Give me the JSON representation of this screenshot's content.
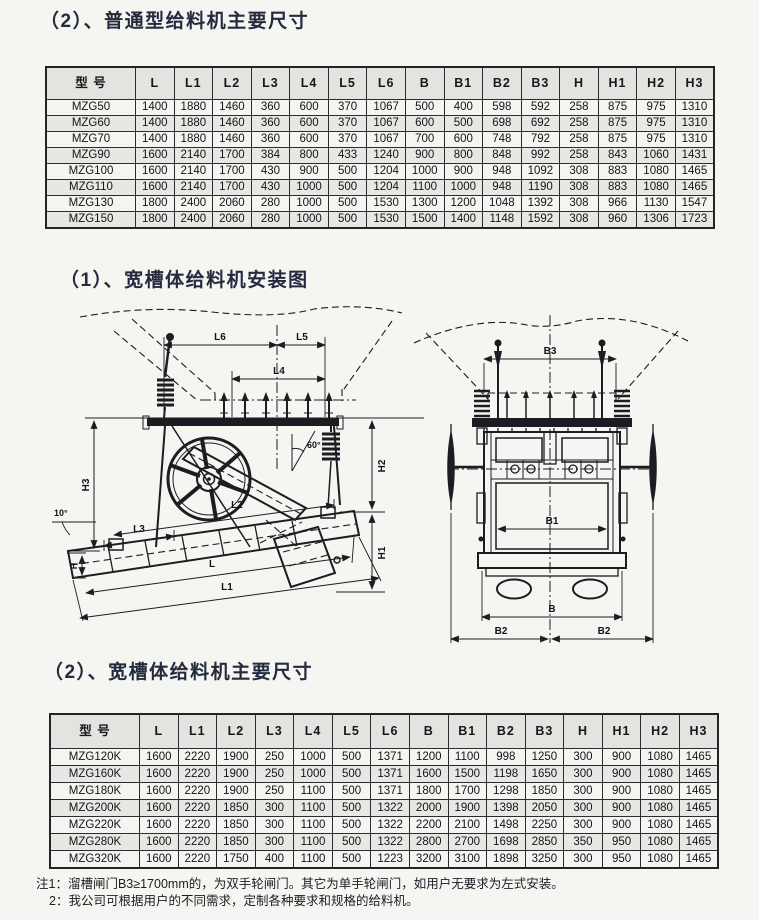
{
  "sections": {
    "s1_title": "（2）、普通型给料机主要尺寸",
    "s2_title": "（1）、宽槽体给料机安装图",
    "s3_title": "（2）、宽槽体给料机主要尺寸"
  },
  "table1": {
    "headers": [
      "型 号",
      "L",
      "L1",
      "L2",
      "L3",
      "L4",
      "L5",
      "L6",
      "B",
      "B1",
      "B2",
      "B3",
      "H",
      "H1",
      "H2",
      "H3"
    ],
    "rows": [
      [
        "MZG50",
        "1400",
        "1880",
        "1460",
        "360",
        "600",
        "370",
        "1067",
        "500",
        "400",
        "598",
        "592",
        "258",
        "875",
        "975",
        "1310"
      ],
      [
        "MZG60",
        "1400",
        "1880",
        "1460",
        "360",
        "600",
        "370",
        "1067",
        "600",
        "500",
        "698",
        "692",
        "258",
        "875",
        "975",
        "1310"
      ],
      [
        "MZG70",
        "1400",
        "1880",
        "1460",
        "360",
        "600",
        "370",
        "1067",
        "700",
        "600",
        "748",
        "792",
        "258",
        "875",
        "975",
        "1310"
      ],
      [
        "MZG90",
        "1600",
        "2140",
        "1700",
        "384",
        "800",
        "433",
        "1240",
        "900",
        "800",
        "848",
        "992",
        "258",
        "843",
        "1060",
        "1431"
      ],
      [
        "MZG100",
        "1600",
        "2140",
        "1700",
        "430",
        "900",
        "500",
        "1204",
        "1000",
        "900",
        "948",
        "1092",
        "308",
        "883",
        "1080",
        "1465"
      ],
      [
        "MZG110",
        "1600",
        "2140",
        "1700",
        "430",
        "1000",
        "500",
        "1204",
        "1100",
        "1000",
        "948",
        "1190",
        "308",
        "883",
        "1080",
        "1465"
      ],
      [
        "MZG130",
        "1800",
        "2400",
        "2060",
        "280",
        "1000",
        "500",
        "1530",
        "1300",
        "1200",
        "1048",
        "1392",
        "308",
        "966",
        "1130",
        "1547"
      ],
      [
        "MZG150",
        "1800",
        "2400",
        "2060",
        "280",
        "1000",
        "500",
        "1530",
        "1500",
        "1400",
        "1148",
        "1592",
        "308",
        "960",
        "1306",
        "1723"
      ]
    ]
  },
  "table2": {
    "headers": [
      "型 号",
      "L",
      "L1",
      "L2",
      "L3",
      "L4",
      "L5",
      "L6",
      "B",
      "B1",
      "B2",
      "B3",
      "H",
      "H1",
      "H2",
      "H3"
    ],
    "rows": [
      [
        "MZG120K",
        "1600",
        "2220",
        "1900",
        "250",
        "1000",
        "500",
        "1371",
        "1200",
        "1100",
        "998",
        "1250",
        "300",
        "900",
        "1080",
        "1465"
      ],
      [
        "MZG160K",
        "1600",
        "2220",
        "1900",
        "250",
        "1000",
        "500",
        "1371",
        "1600",
        "1500",
        "1198",
        "1650",
        "300",
        "900",
        "1080",
        "1465"
      ],
      [
        "MZG180K",
        "1600",
        "2220",
        "1900",
        "250",
        "1100",
        "500",
        "1371",
        "1800",
        "1700",
        "1298",
        "1850",
        "300",
        "900",
        "1080",
        "1465"
      ],
      [
        "MZG200K",
        "1600",
        "2220",
        "1850",
        "300",
        "1100",
        "500",
        "1322",
        "2000",
        "1900",
        "1398",
        "2050",
        "300",
        "900",
        "1080",
        "1465"
      ],
      [
        "MZG220K",
        "1600",
        "2220",
        "1850",
        "300",
        "1100",
        "500",
        "1322",
        "2200",
        "2100",
        "1498",
        "2250",
        "300",
        "900",
        "1080",
        "1465"
      ],
      [
        "MZG280K",
        "1600",
        "2220",
        "1850",
        "300",
        "1100",
        "500",
        "1322",
        "2800",
        "2700",
        "1698",
        "2850",
        "350",
        "950",
        "1080",
        "1465"
      ],
      [
        "MZG320K",
        "1600",
        "2220",
        "1750",
        "400",
        "1100",
        "500",
        "1223",
        "3200",
        "3100",
        "1898",
        "3250",
        "300",
        "950",
        "1080",
        "1465"
      ]
    ]
  },
  "diagram": {
    "side_view": {
      "l6": "L6",
      "l5": "L5",
      "l4": "L4",
      "l3": "L3",
      "l2": "L2",
      "l1": "L1",
      "l": "L",
      "h3": "H3",
      "h2": "H2",
      "h1": "H1",
      "h": "H",
      "angle_top": "60°",
      "angle_incline": "10°"
    },
    "front_view": {
      "b3": "B3",
      "b1": "B1",
      "b": "B",
      "b2_left": "B2",
      "b2_right": "B2"
    }
  },
  "notes": {
    "line1": "注1：溜槽闸门B3≥1700mm的，为双手轮闸门。其它为单手轮闸门，如用户无要求为左式安装。",
    "line2": "2：我公司可根据用户的不同需求，定制各种要求和规格的给料机。"
  }
}
